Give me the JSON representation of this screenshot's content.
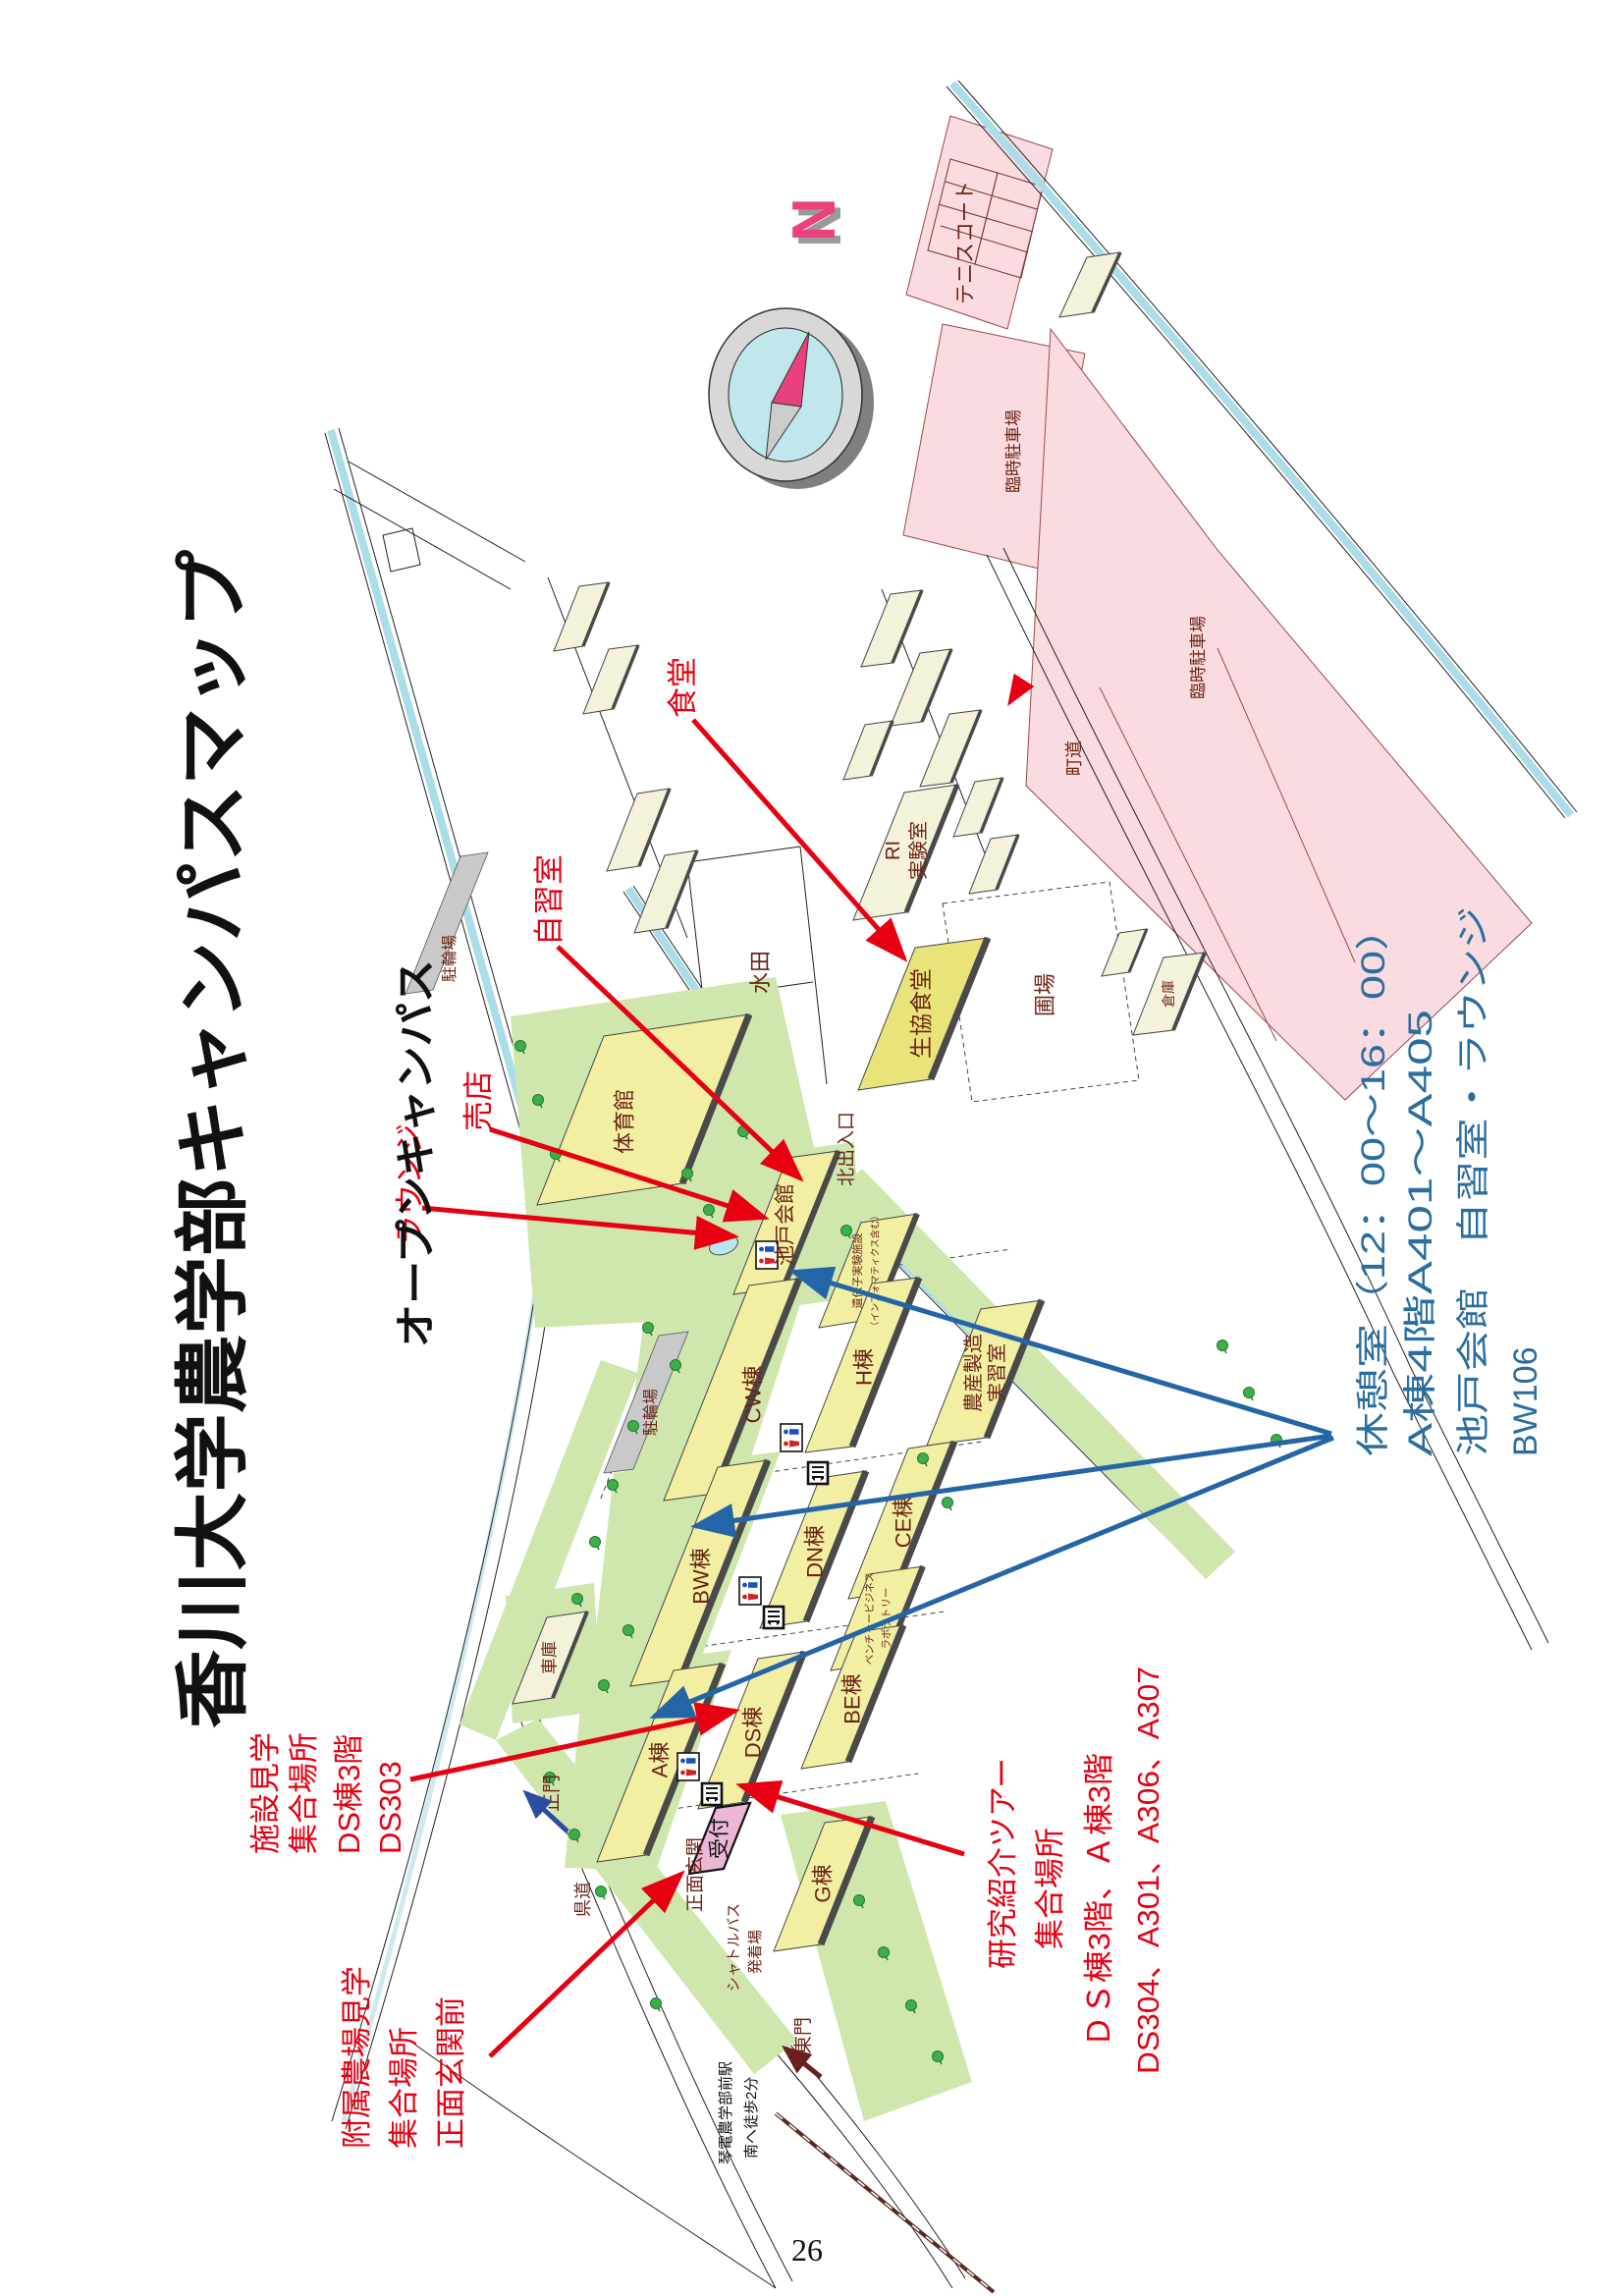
{
  "header": {
    "title": "香川大学農学部キャンパスマップ",
    "subtitle": "オープンキャンパス"
  },
  "page": {
    "number": "26"
  },
  "compass": {
    "north": "N"
  },
  "colors": {
    "building_fill": "#f2efa2",
    "building_cream": "#f4f2da",
    "canteen_fill": "#e9e47a",
    "green": "#cfe6ad",
    "pink_area": "#fadbdf",
    "water": "#aadde8",
    "gray_strip": "#c9c9c9",
    "map_label": "#6b2417",
    "annotation_red": "#e60012",
    "annotation_blue": "#2a6e9f",
    "reception_pink": "#ecb7d6"
  },
  "buildings": {
    "gym": "体育館",
    "ikeda_hall": "池戸会館",
    "gene_lab_1": "遺伝子実験施設",
    "gene_lab_2": "（インフォマティクス含む）",
    "cw": "CW棟",
    "h": "H棟",
    "nosan_1": "農産製造",
    "nosan_2": "実習室",
    "bw": "BW棟",
    "dn": "DN棟",
    "ce": "CE棟",
    "vbl_1": "ベンチャービジネス",
    "vbl_2": "ラボラトリー",
    "a": "A棟",
    "ds": "DS棟",
    "be": "BE棟",
    "g": "G棟",
    "seikyo": "生協食堂",
    "ri_1": "RI",
    "ri_2": "実験室",
    "shako": "車庫",
    "soko": "倉庫",
    "reception": "受付"
  },
  "places": {
    "tennis": "テニスコート",
    "parking1": "臨時駐車場",
    "parking2": "臨時駐車場",
    "suiden": "水田",
    "hojo": "圃場",
    "churinjo1": "駐輪場",
    "churinjo2": "駐輪場",
    "kita_gate": "北出入口",
    "main_gate": "正門",
    "east_gate": "東門",
    "front_entrance": "正面玄関",
    "shuttle_1": "シャトルバス",
    "shuttle_2": "発着場",
    "station_1": "琴電農学部前駅",
    "station_2": "南へ徒歩2分",
    "road_cho": "町道",
    "road_ken": "県道"
  },
  "annotations": {
    "canteen": "食堂",
    "study_room": "自習室",
    "shop": "売店",
    "lounge": "ラウンジ",
    "facility_tour": [
      "施設見学",
      "集合場所",
      "DS棟3階",
      "DS303"
    ],
    "farm_tour": [
      "附属農場見学",
      "集合場所",
      "正面玄関前"
    ],
    "research_tour": [
      "研究紹介ツアー",
      "集合場所",
      "ＤＳ棟3階、Ａ棟3階",
      "DS304、A301、A306、A307"
    ],
    "rest_note": [
      "休憩室（12：00～16：00）",
      "A棟4階A401～A405",
      "池戸会館　自習室・ラウンジ",
      "BW106"
    ]
  }
}
